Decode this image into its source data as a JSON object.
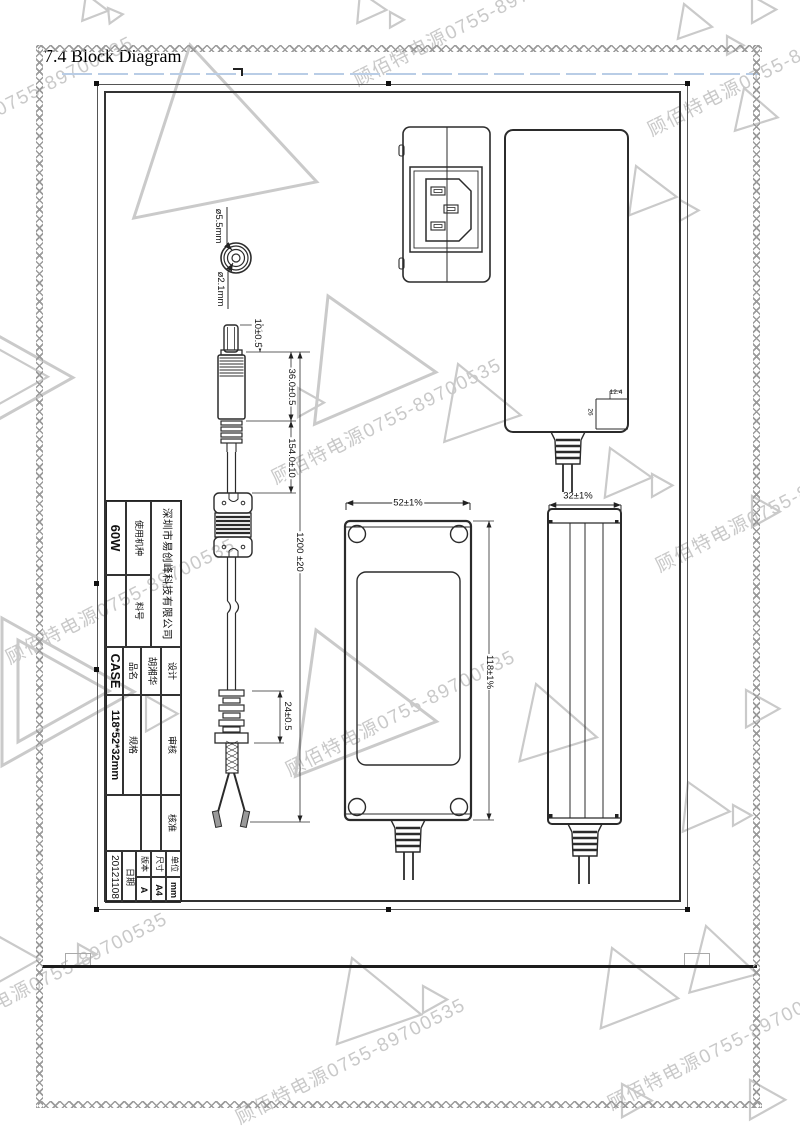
{
  "document": {
    "section_title": "7.4 Block Diagram"
  },
  "watermark": {
    "text": "顾佰特电源0755-89700535"
  },
  "drawing": {
    "plug_front": {
      "outer_dia": "ø5.5mm",
      "inner_dia": "ø2.1mm"
    },
    "cable": {
      "tip_length": "10±0.5",
      "plug_length": "36.0±0.5",
      "plug_to_ferrite": "154.0±10",
      "total_length": "1200 ±20",
      "bushing_length": "24±0.5"
    },
    "case": {
      "width": "52±1%",
      "length": "118±1%",
      "height": "32±1%"
    },
    "cord_exit": {
      "width": "12.4",
      "height": "26"
    }
  },
  "title_block": {
    "company": "深圳市易创峰科技有限公司",
    "model_label": "使用机种",
    "model_value": "60W",
    "part_no_label": "料号",
    "part_no_value": "",
    "product_label": "品名",
    "product_value": "CASE",
    "spec_label": "规格",
    "spec_value": "118*52*32mm",
    "date_label": "日期",
    "date_value": "20121108",
    "design_label": "设计",
    "design_value": "胡湘华",
    "review_label": "审核",
    "review_value": "",
    "approve_label": "核准",
    "approve_value": "",
    "unit_label": "单位",
    "unit_value": "mm",
    "size_label": "尺寸",
    "size_value": "A4",
    "version_label": "版本",
    "version_value": "A"
  }
}
